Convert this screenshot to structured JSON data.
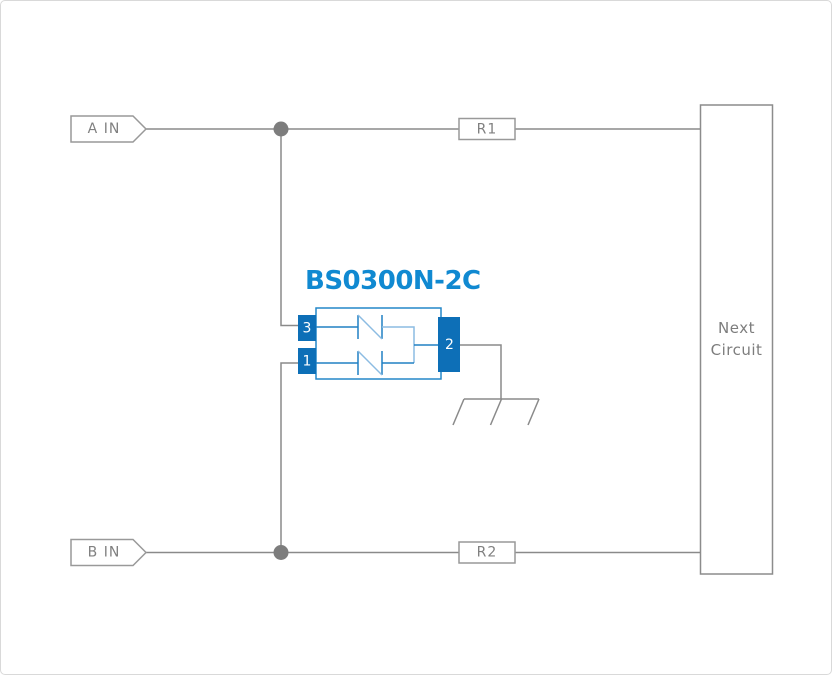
{
  "diagram_title": "BS0300N-2C application circuit",
  "colors": {
    "wire_gray": "#8a8a8a",
    "outline_gray": "#999999",
    "label_gray": "#808080",
    "junction_dot": "#7d7d7d",
    "component_label_blue": "#1089d1",
    "pin_fill_blue": "#0d6fb7",
    "component_stroke_blue": "#2487c9",
    "component_stroke_light_blue": "#8cbce2",
    "background": "#ffffff",
    "page_border": "#d9d9d9"
  },
  "ports": [
    {
      "label": "A IN"
    },
    {
      "label": "B IN"
    }
  ],
  "resistors": [
    {
      "label": "R1"
    },
    {
      "label": "R2"
    }
  ],
  "component": {
    "label": "BS0300N-2C",
    "pins": [
      {
        "number": "3"
      },
      {
        "number": "1"
      },
      {
        "number": "2"
      }
    ]
  },
  "next_circuit": {
    "label_line1": "Next",
    "label_line2": "Circuit"
  }
}
